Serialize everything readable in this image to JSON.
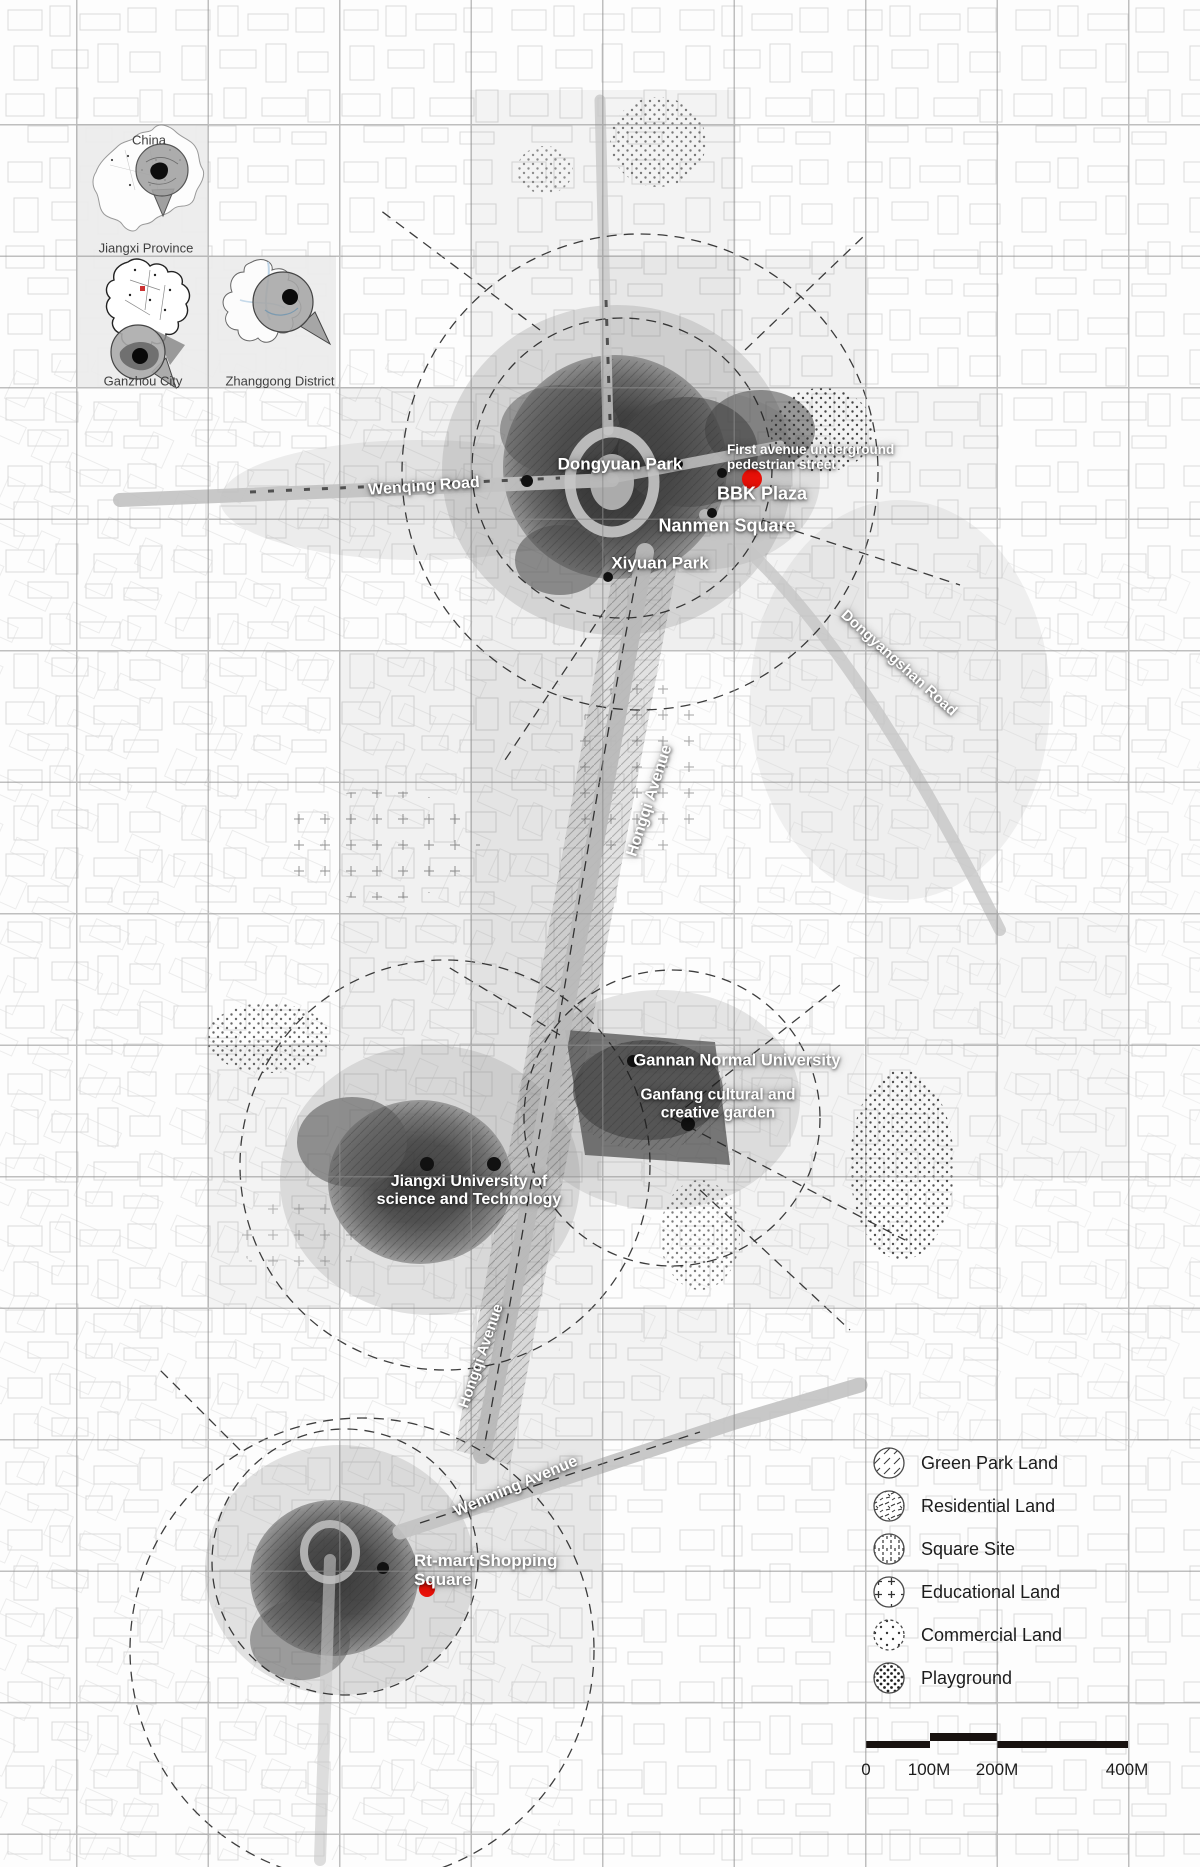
{
  "insets": {
    "china": "China",
    "jiangxi": "Jiangxi Province",
    "ganzhou": "Ganzhou City",
    "zhanggong": "Zhanggong District"
  },
  "roads": {
    "wenqing": "Wenqing Road",
    "dongyangshan": "Dongyangshan Road",
    "hongqi_north": "Hongqi Avenue",
    "hongqi_south": "Hongqi Avenue",
    "wenming": "Wenming Avenue"
  },
  "places": {
    "dongyuan_park": "Dongyuan Park",
    "underground_street_line1": "First avenue underground",
    "underground_street_line2": "pedestrian street",
    "bbk_plaza": "BBK Plaza",
    "nanmen_square": "Nanmen Square",
    "xiyuan_park": "Xiyuan Park",
    "gannan_normal_university": "Gannan Normal University",
    "ganfang_line1": "Ganfang cultural and",
    "ganfang_line2": "creative garden",
    "jiangxi_univ_line1": "Jiangxi University of",
    "jiangxi_univ_line2": "science and Technology",
    "rt_mart_line1": "Rt-mart Shopping",
    "rt_mart_line2": "Square"
  },
  "legend": {
    "items": [
      {
        "label": "Green Park Land",
        "icon": "diagonal-hatch-circle-icon"
      },
      {
        "label": "Residential Land",
        "icon": "scribble-circle-icon"
      },
      {
        "label": "Square Site",
        "icon": "vertical-dash-circle-icon"
      },
      {
        "label": "Educational Land",
        "icon": "plus-hatch-circle-icon"
      },
      {
        "label": "Commercial Land",
        "icon": "sparse-dots-circle-icon"
      },
      {
        "label": "Playground",
        "icon": "dense-dots-circle-icon"
      }
    ]
  },
  "scale_bar": {
    "ticks": [
      "0",
      "100M",
      "200M",
      "400M"
    ]
  },
  "colors": {
    "poi_red": "#e81109",
    "poi_black": "#111111",
    "grid_line": "#8d8d8d"
  }
}
